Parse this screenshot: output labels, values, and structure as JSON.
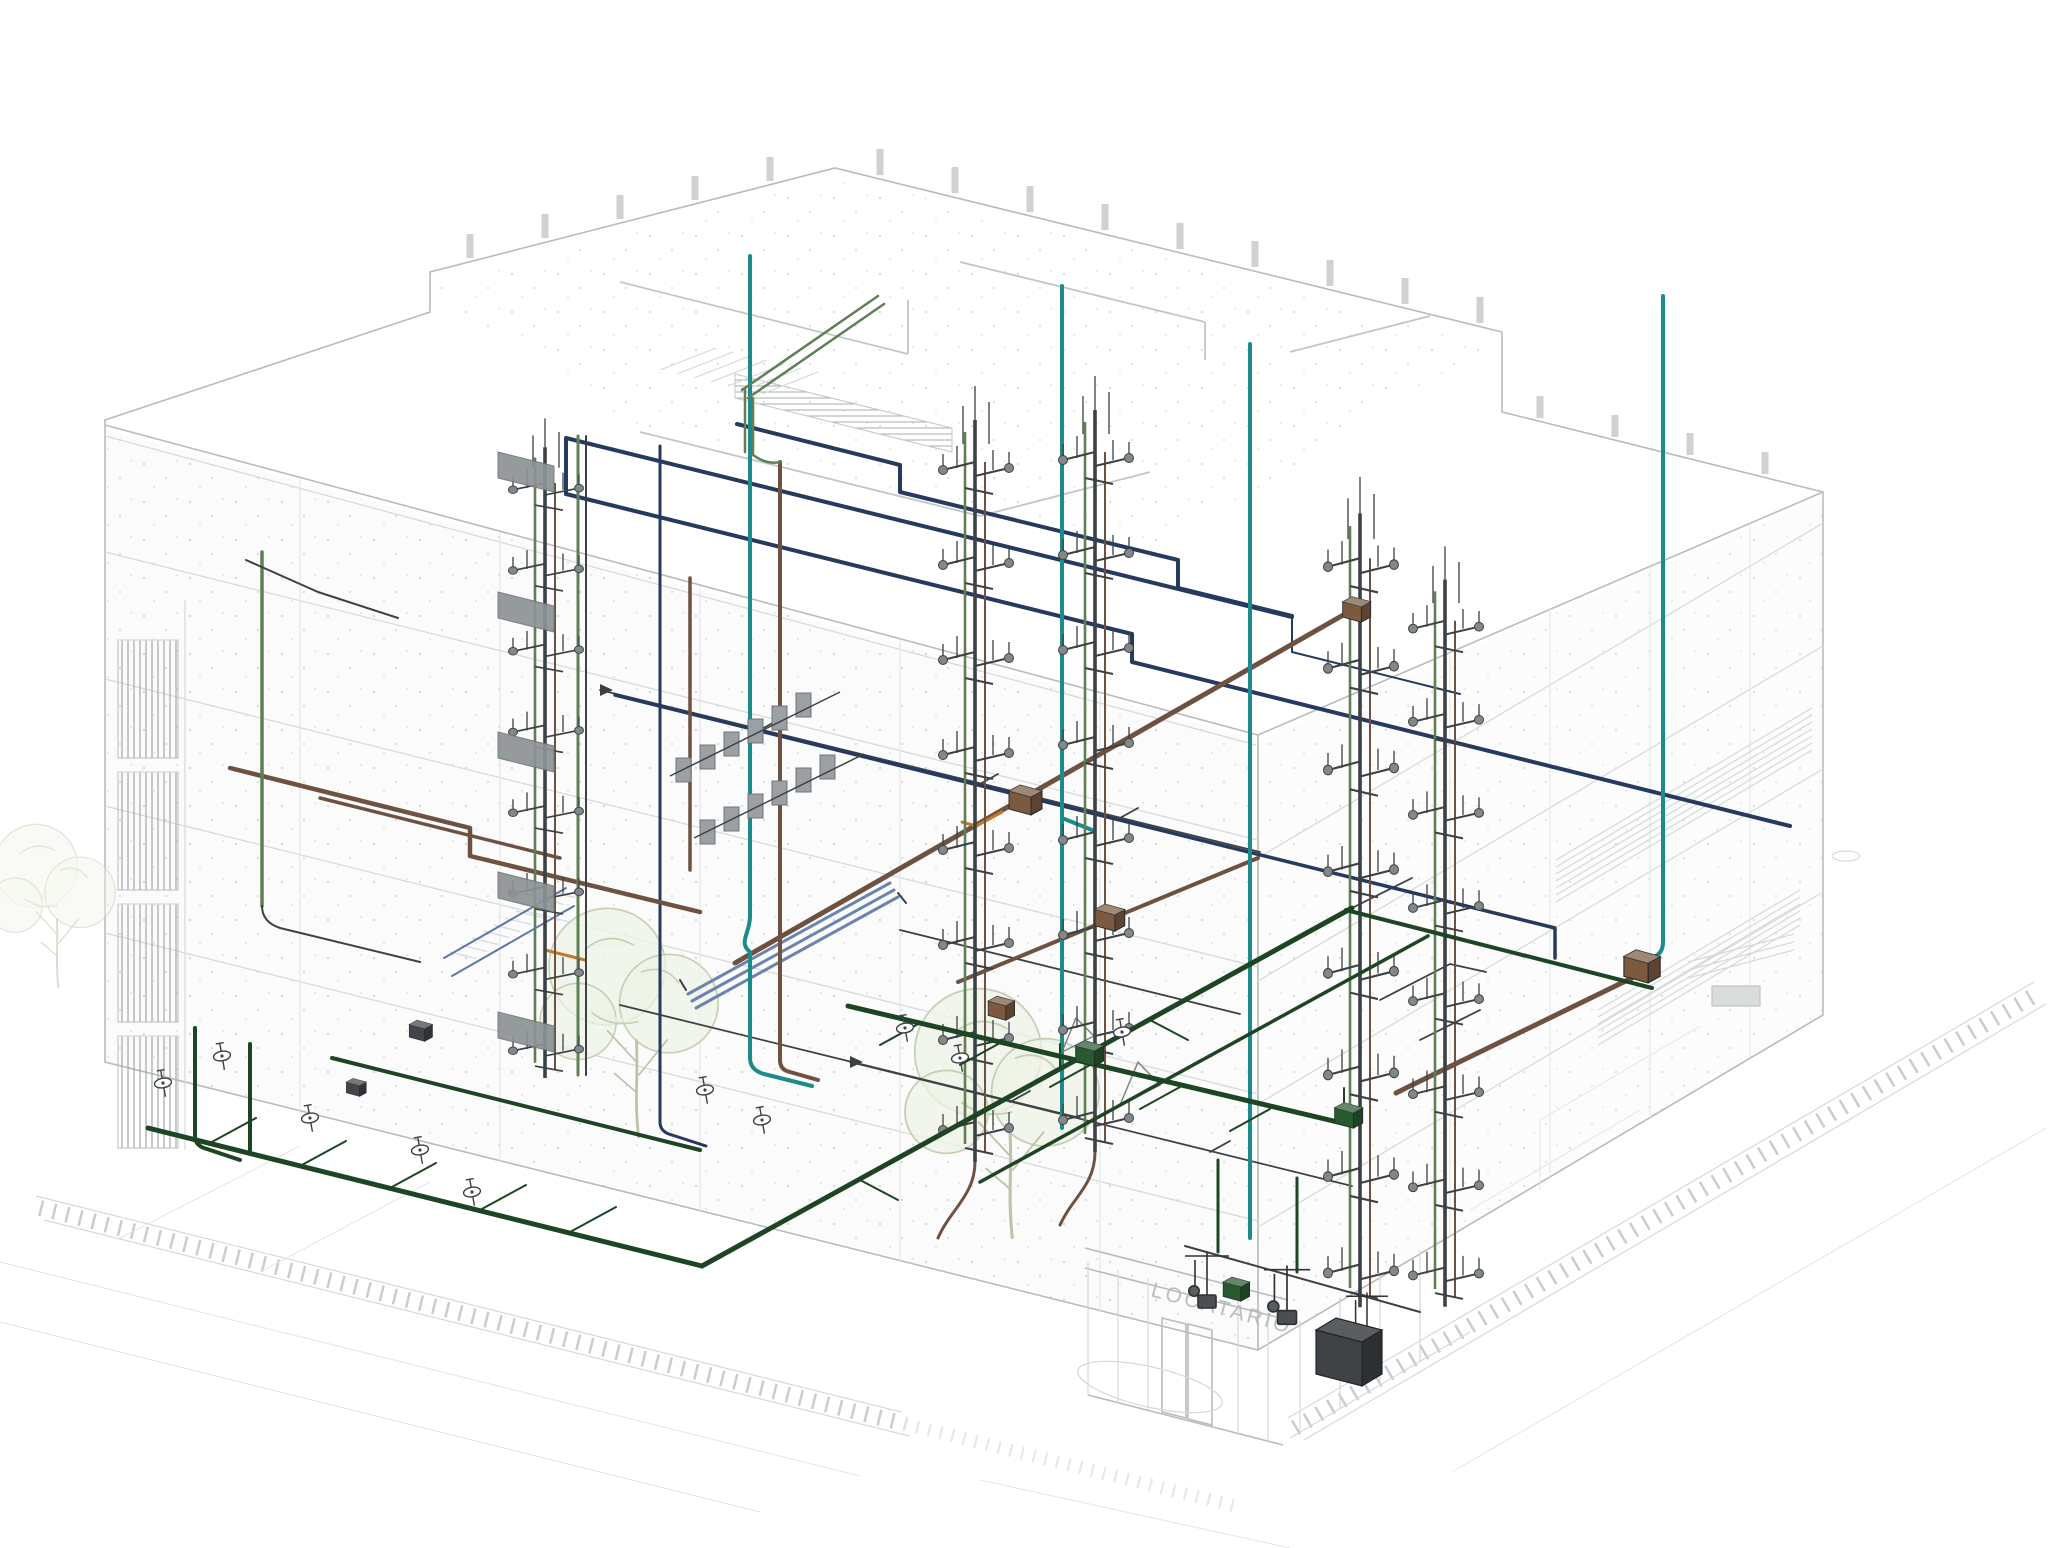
{
  "scene": {
    "type": "3d-axonometric-bim-model",
    "storefront_sign": "LOCATARIO"
  },
  "colors": {
    "background": "#ffffff",
    "shell_line": "#b8bcbe",
    "shell_line_light": "#d6d9da",
    "interior_line": "#c2c6c7",
    "speckle": "#a9afb1",
    "ground_hatch": "#c9cdce",
    "pipe_dark_green": "#1d4423",
    "pipe_sage_green": "#5f7f55",
    "pipe_teal": "#1b8b8b",
    "pipe_navy": "#26395e",
    "pipe_steel_blue": "#6b83ad",
    "pipe_brown": "#6e5140",
    "pipe_orange": "#c0782c",
    "equipment_gray": "#9aa0a3",
    "fixture_dark": "#3c4144",
    "box_green": "#275a2e",
    "box_copper": "#7c5a40",
    "box_dark": "#42464a",
    "handrail_blue": "#5e77a6",
    "tree_stroke": "#c5d1b5",
    "tree_fill": "#eef2e6",
    "sign_text": "#b3b8ba"
  },
  "systems": [
    {
      "id": "dark-green-piping",
      "color": "#1d4423"
    },
    {
      "id": "sage-green-piping",
      "color": "#5f7f55"
    },
    {
      "id": "teal-piping",
      "color": "#1b8b8b"
    },
    {
      "id": "navy-piping",
      "color": "#26395e"
    },
    {
      "id": "steel-blue-pipe-bundle",
      "color": "#6b83ad"
    },
    {
      "id": "brown-piping",
      "color": "#6e5140"
    },
    {
      "id": "orange-piping",
      "color": "#c0782c"
    }
  ],
  "counts": {
    "riser_towers": 5,
    "trees": 3,
    "junction_boxes": 8,
    "floors": 5
  }
}
